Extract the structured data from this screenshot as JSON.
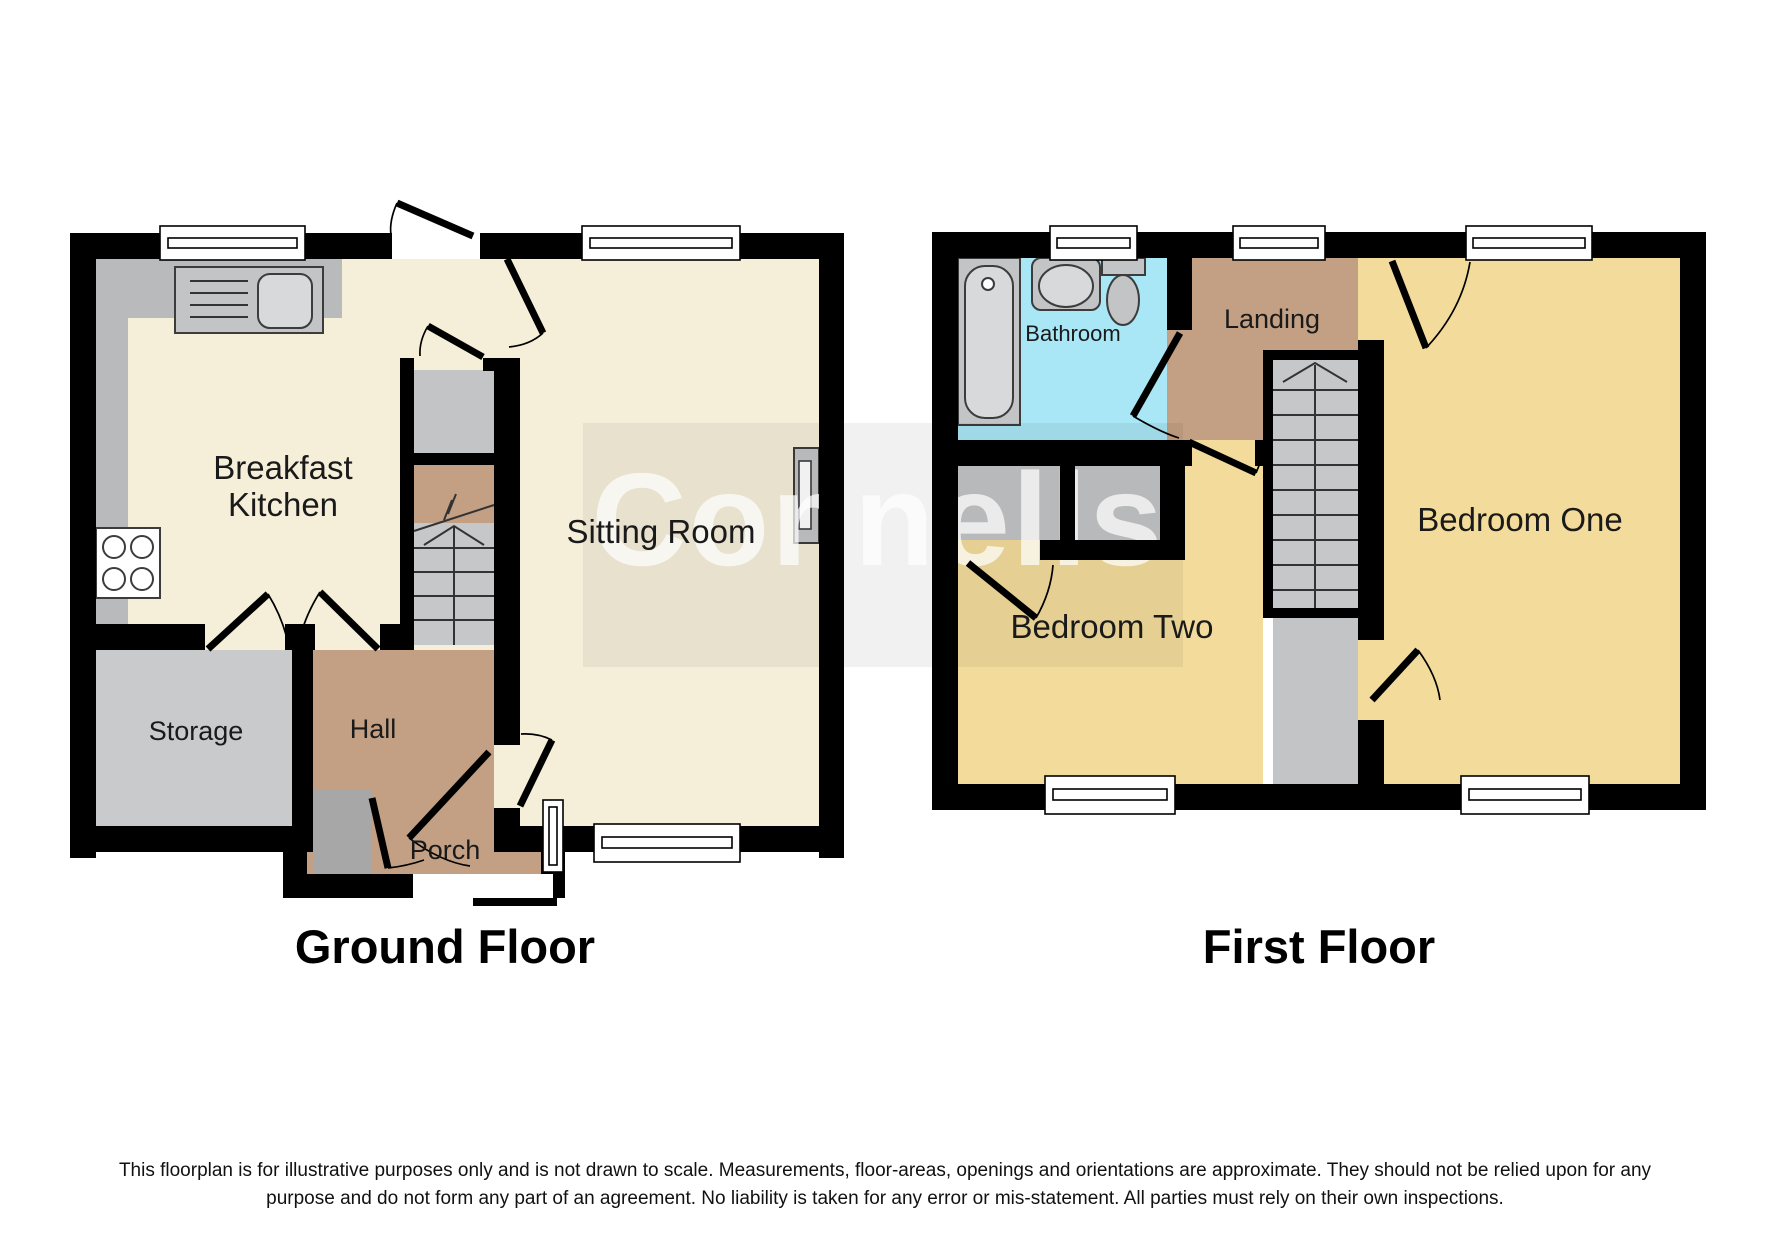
{
  "watermark": {
    "text": "Connells"
  },
  "colors": {
    "wall": "#000000",
    "cream": "#f5efd9",
    "tan": "#c3a083",
    "yellow": "#f3db9b",
    "blue": "#a9e6f6",
    "storage_gray": "#c9cacb",
    "fixture_gray": "#c3c4c5",
    "stair_gray": "#c6c7c8",
    "dark_gray": "#a7a7a7",
    "counter_gray": "#b9babb",
    "window_white": "#ffffff"
  },
  "ground_floor": {
    "title": "Ground Floor",
    "rooms": {
      "breakfast_kitchen_line1": "Breakfast",
      "breakfast_kitchen_line2": "Kitchen",
      "sitting_room": "Sitting Room",
      "storage": "Storage",
      "hall": "Hall",
      "porch": "Porch"
    }
  },
  "first_floor": {
    "title": "First Floor",
    "rooms": {
      "bathroom": "Bathroom",
      "landing": "Landing",
      "bedroom_one": "Bedroom One",
      "bedroom_two": "Bedroom Two"
    }
  },
  "disclaimer": {
    "line1": "This floorplan is for illustrative purposes only and is not drawn to scale. Measurements, floor-areas, openings and orientations are approximate. They should not be relied upon for any",
    "line2": "purpose and do not form any part of an agreement. No liability is taken for any error or mis-statement. All parties must rely on their own inspections."
  }
}
